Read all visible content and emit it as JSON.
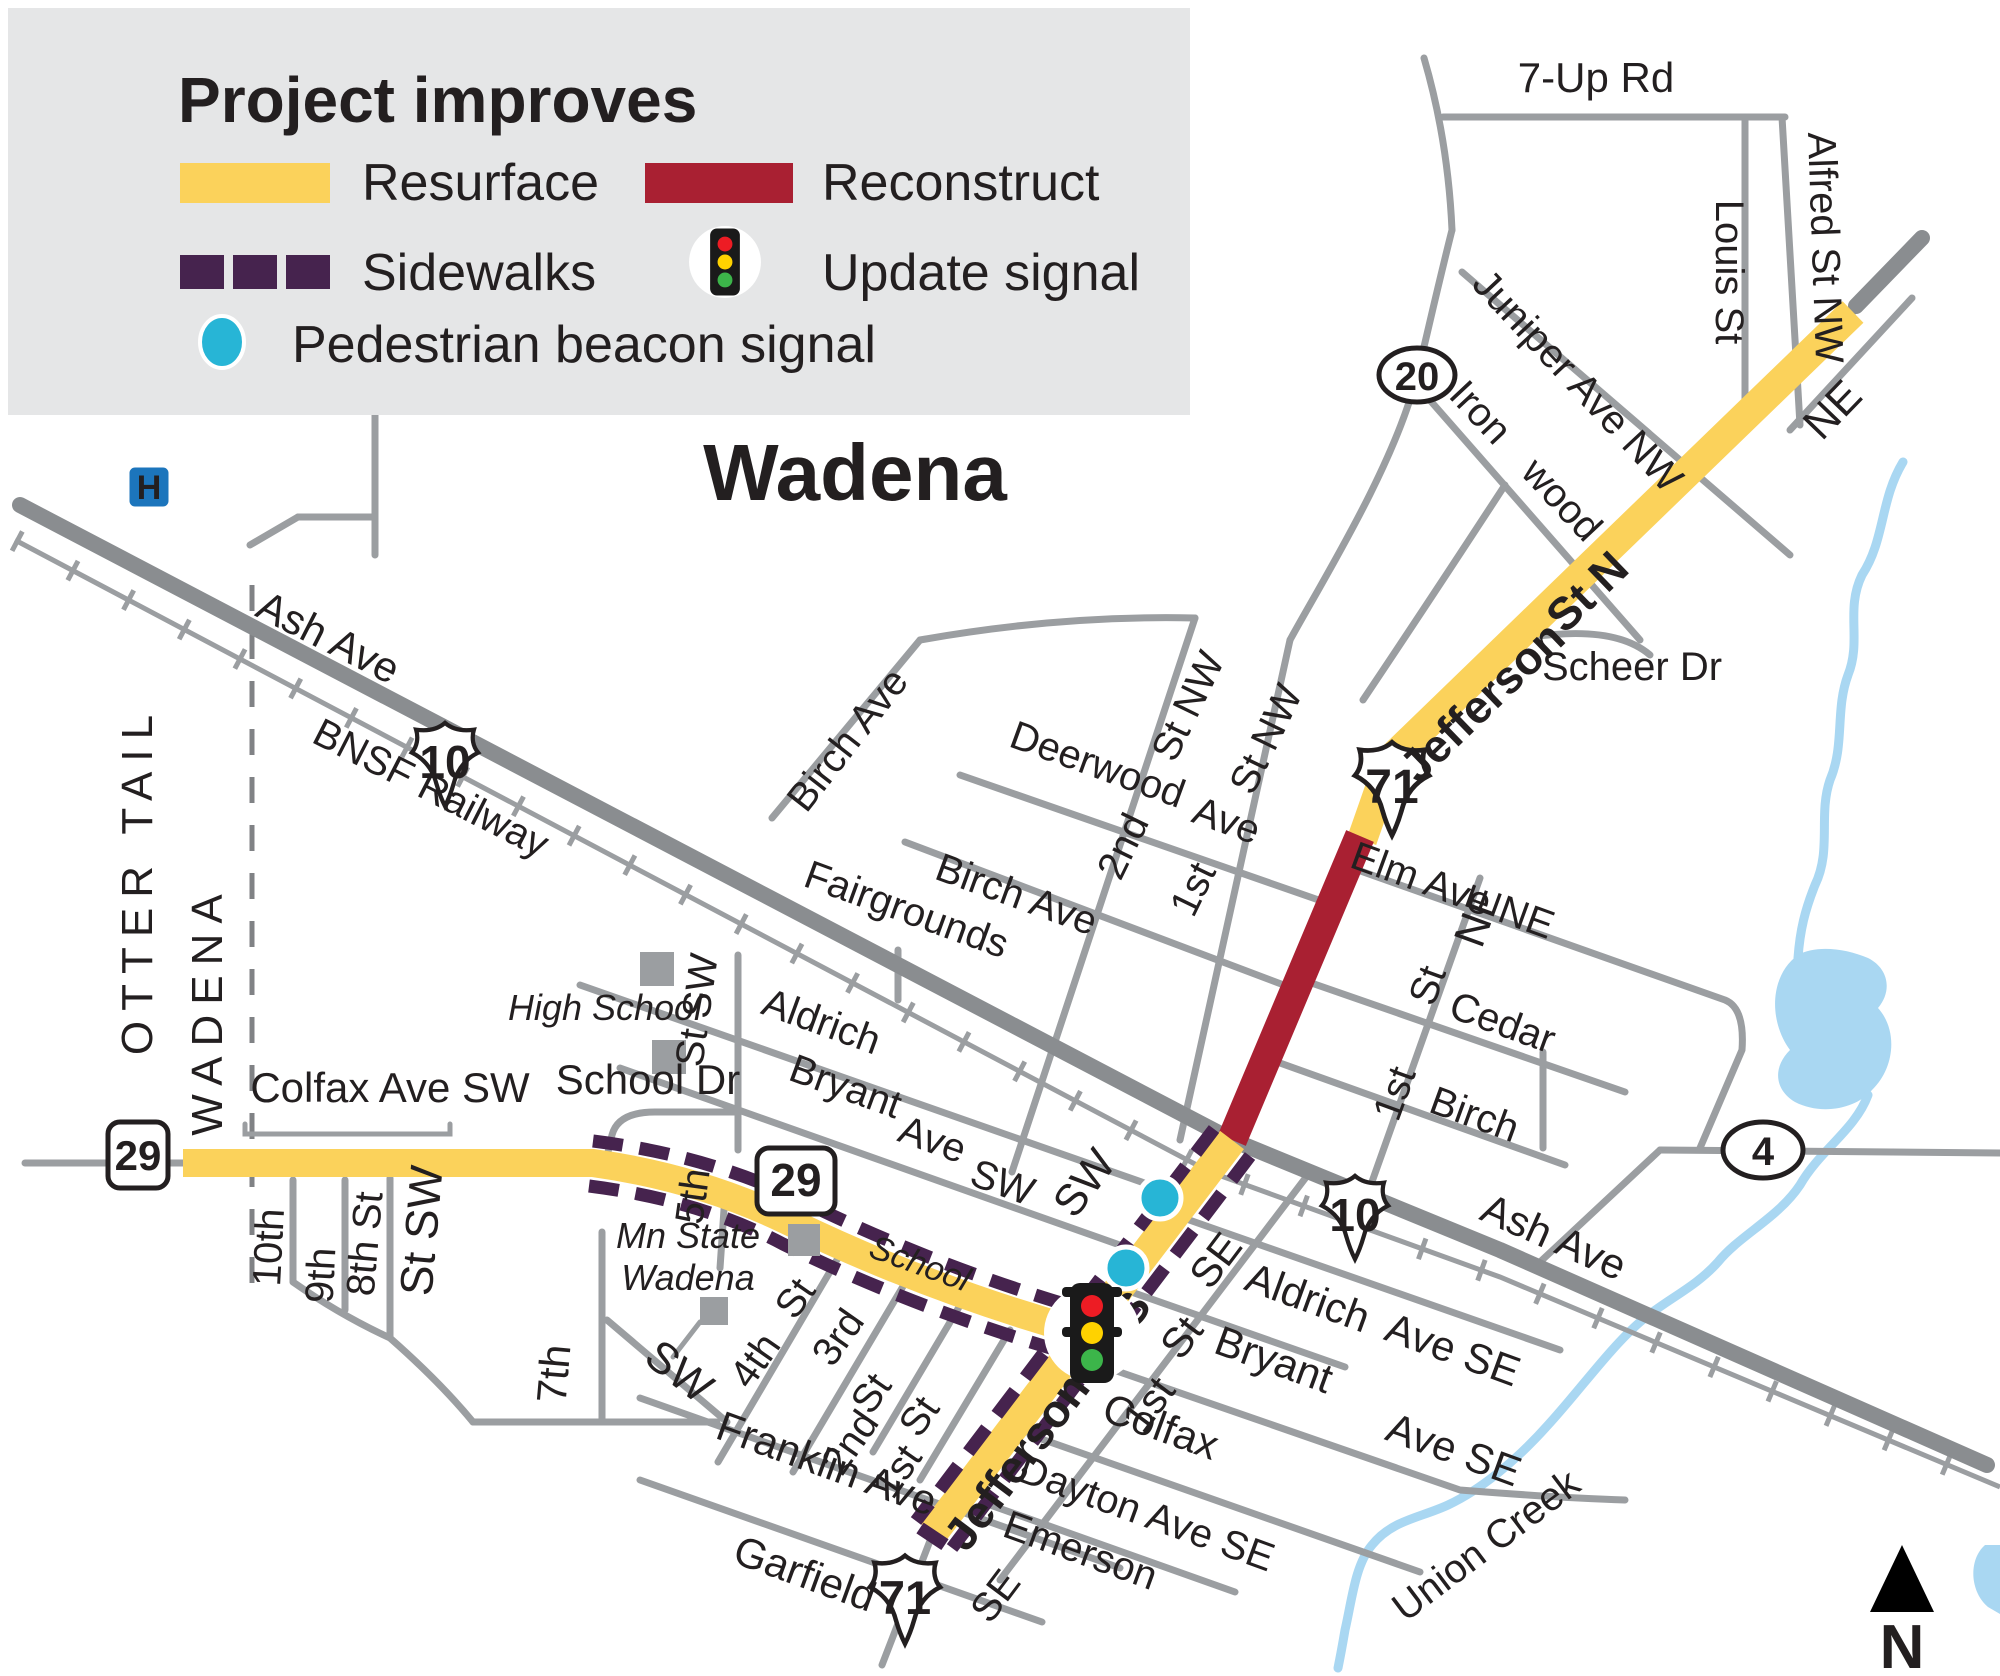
{
  "legend": {
    "title": "Project improves",
    "resurface": "Resurface",
    "reconstruct": "Reconstruct",
    "sidewalks": "Sidewalks",
    "update_signal": "Update signal",
    "pedestrian_beacon": "Pedestrian beacon signal"
  },
  "city": {
    "title": "Wadena",
    "county_left": "OTTER TAIL",
    "county_right": "WADENA"
  },
  "shields": {
    "us10_west": "10",
    "us10_east": "10",
    "us71_north": "71",
    "us71_south": "71",
    "mn29_west": "29",
    "mn29_mid": "29",
    "cr20": "20",
    "cr4": "4"
  },
  "compass": {
    "north": "N"
  },
  "hospital": {
    "h": "H"
  },
  "streets": {
    "seven_up": "7-Up Rd",
    "alfred": "Alfred St NW",
    "louis": "Louis St",
    "juniper": "Juniper Ave NW",
    "ironwood": "Iron wood",
    "ne_corner": "NE",
    "jefferson_n": "Jefferson",
    "jefferson_stn": "St N",
    "scheer": "Scheer Dr",
    "elm": "Elm Ave NE",
    "deerwood": "Deerwood",
    "deerwood_ave": "Ave",
    "st_nw_1": "St NW",
    "second_nw": "2nd",
    "st_nw_2": "St NW",
    "first_nw": "1st",
    "birch_ave_w": "Birch Ave",
    "fairgrounds": "Fairgrounds",
    "birch_ave_diag": "Birch Ave",
    "ash_ave_w": "Ash Ave",
    "bnsf": "BNSF Railway",
    "colfax_sw": "Colfax Ave SW",
    "school_dr": "School Dr",
    "high_school": "High School",
    "st_sw_5th": "St SW",
    "fifth": "5th",
    "tenth": "10th",
    "ninth": "9th",
    "eighth": "8th St",
    "st_sw_big": "St SW",
    "seventh": "7th",
    "sw_diag": "SW",
    "mn_state_1": "Mn State",
    "mn_state_2": "Wadena",
    "school_it": "School",
    "aldrich_sw": "Aldrich",
    "bryant_sw": "Bryant",
    "bryant_ave": "Ave",
    "bryant_sw2": "SW",
    "sw_jeff": "SW",
    "st_4th": "St",
    "fourth": "4th",
    "third": "3rd",
    "st_2nd": "St",
    "second_s": "2nd",
    "st_1st": "St",
    "first_s": "1st",
    "franklin": "Franklin Ave",
    "garfield": "Garfield",
    "jefferson_s": "Jefferson St S",
    "se_1": "SE",
    "aldrich_se": "Aldrich",
    "aldrich_ave_se": "Ave SE",
    "st_1se": "St",
    "bryant_se": "Bryant",
    "first_se": "1st",
    "colfax_se": "Colfax",
    "colfax_ave_se": "Ave SE",
    "dayton": "Dayton Ave SE",
    "emerson": "Emerson",
    "se_2": "SE",
    "ash_ave_e": "Ash Ave",
    "union_creek": "Union Creek",
    "ne_1stne": "NE",
    "st_1stne": "St",
    "cedar": "Cedar",
    "first_ne": "1st",
    "birch_ne": "Birch"
  },
  "colors": {
    "resurface": "#FBD25B",
    "reconstruct": "#A92032",
    "sidewalk": "#46234E",
    "beacon": "#27B5D6",
    "road": "#9B9EA1",
    "highway": "#8A8D90",
    "water": "#A9D7F2",
    "legend_bg": "#E5E6E7",
    "text": "#231F20",
    "hospital_blue": "#1C75BC",
    "signal_red": "#ED1C24",
    "signal_yellow": "#FFD200",
    "signal_green": "#3CB54A"
  }
}
